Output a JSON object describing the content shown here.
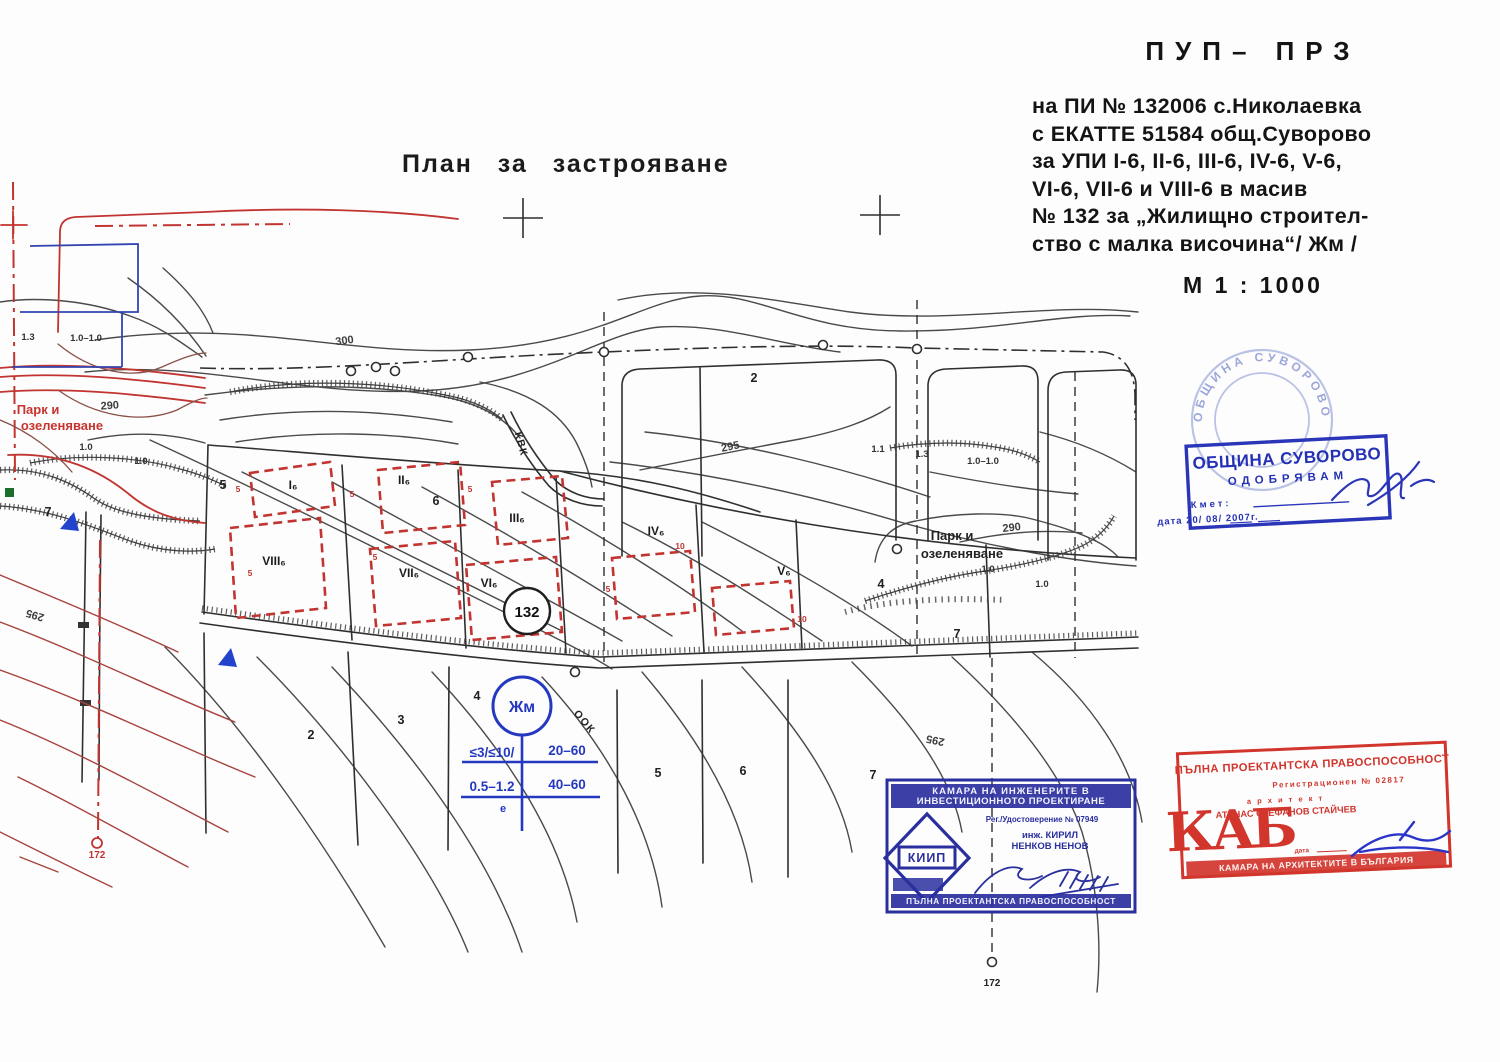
{
  "header": {
    "plan_title": "План за застрояване",
    "doc_type": "ПУП– ПРЗ",
    "line1": "на ПИ  №  132006  с.Николаевка",
    "line2": "с ЕКАТТЕ  51584  общ.Суворово",
    "line3": "за УПИ  I-6, II-6,  III-6, IV-6, V-6,",
    "line4": "VI-6, VII-6  и  VIII-6  в  масив",
    "line5": "№ 132  за „Жилищно  строител-",
    "line6": "ство  с малка  височина“/ Жм /",
    "scale": "М  1 : 1000"
  },
  "legend": {
    "zone": "Жм",
    "row1_left": "≤3/≤10/",
    "row1_right": "20–60",
    "row2_left": "0.5–1.2",
    "row2_right": "40–60",
    "note": "е"
  },
  "map": {
    "massif_number": "132",
    "labels": [
      {
        "t": "300",
        "x": 345,
        "y": 344,
        "cls": "cont",
        "rot": -8
      },
      {
        "t": "295",
        "x": 731,
        "y": 450,
        "cls": "cont",
        "rot": -12
      },
      {
        "t": "290",
        "x": 1012,
        "y": 531,
        "cls": "cont",
        "rot": -6
      },
      {
        "t": "295",
        "x": 36,
        "y": 612,
        "cls": "cont",
        "rot": 197
      },
      {
        "t": "295",
        "x": 936,
        "y": 737,
        "cls": "cont",
        "rot": 192
      },
      {
        "t": "290",
        "x": 110,
        "y": 409,
        "cls": "cont",
        "rot": -4
      },
      {
        "t": "2",
        "x": 754,
        "y": 382,
        "cls": "plot"
      },
      {
        "t": "2",
        "x": 311,
        "y": 739,
        "cls": "plot"
      },
      {
        "t": "3",
        "x": 401,
        "y": 724,
        "cls": "plot"
      },
      {
        "t": "4",
        "x": 477,
        "y": 700,
        "cls": "plot"
      },
      {
        "t": "5",
        "x": 658,
        "y": 777,
        "cls": "plot"
      },
      {
        "t": "6",
        "x": 743,
        "y": 775,
        "cls": "plot"
      },
      {
        "t": "7",
        "x": 873,
        "y": 779,
        "cls": "plot"
      },
      {
        "t": "7",
        "x": 957,
        "y": 638,
        "cls": "plot"
      },
      {
        "t": "7",
        "x": 48,
        "y": 516,
        "cls": "plot"
      },
      {
        "t": "5",
        "x": 223,
        "y": 489,
        "cls": "plot"
      },
      {
        "t": "4",
        "x": 881,
        "y": 588,
        "cls": "plot"
      },
      {
        "t": "6",
        "x": 436,
        "y": 505,
        "cls": "plot"
      },
      {
        "t": "I₆",
        "x": 293,
        "y": 489,
        "cls": "upi"
      },
      {
        "t": "II₆",
        "x": 404,
        "y": 484,
        "cls": "upi"
      },
      {
        "t": "III₆",
        "x": 517,
        "y": 522,
        "cls": "upi"
      },
      {
        "t": "IV₆",
        "x": 656,
        "y": 535,
        "cls": "upi"
      },
      {
        "t": "V₆",
        "x": 784,
        "y": 575,
        "cls": "upi"
      },
      {
        "t": "VI₆",
        "x": 489,
        "y": 587,
        "cls": "upi"
      },
      {
        "t": "VII₆",
        "x": 409,
        "y": 577,
        "cls": "upi"
      },
      {
        "t": "VIII₆",
        "x": 274,
        "y": 565,
        "cls": "upi"
      },
      {
        "t": "1.3",
        "x": 28,
        "y": 340,
        "cls": "small"
      },
      {
        "t": "1.0–1.0",
        "x": 86,
        "y": 341,
        "cls": "small"
      },
      {
        "t": "1.1",
        "x": 878,
        "y": 452,
        "cls": "small"
      },
      {
        "t": "1.3",
        "x": 922,
        "y": 457,
        "cls": "small"
      },
      {
        "t": "1.0–1.0",
        "x": 983,
        "y": 464,
        "cls": "small"
      },
      {
        "t": "1.0",
        "x": 988,
        "y": 572,
        "cls": "small"
      },
      {
        "t": "1.0",
        "x": 1042,
        "y": 587,
        "cls": "small"
      },
      {
        "t": "1.0",
        "x": 86,
        "y": 450,
        "cls": "small"
      },
      {
        "t": "1.0",
        "x": 141,
        "y": 464,
        "cls": "small"
      },
      {
        "t": "172",
        "x": 992,
        "y": 986,
        "cls": "pt"
      },
      {
        "t": "172",
        "x": 97,
        "y": 858,
        "cls": "ptred"
      },
      {
        "t": "Парк и",
        "x": 38,
        "y": 414,
        "cls": "parkred"
      },
      {
        "t": "озеленяване",
        "x": 62,
        "y": 430,
        "cls": "parkred"
      },
      {
        "t": "Парк и",
        "x": 952,
        "y": 540,
        "cls": "parkblk"
      },
      {
        "t": "озеленяване",
        "x": 962,
        "y": 558,
        "cls": "parkblk"
      },
      {
        "t": "КВК",
        "x": 518,
        "y": 445,
        "cls": "rotlab",
        "rot": 75
      },
      {
        "t": "ООК",
        "x": 582,
        "y": 724,
        "cls": "rotlab",
        "rot": 50
      },
      {
        "t": "5",
        "x": 238,
        "y": 492,
        "cls": "dim"
      },
      {
        "t": "5",
        "x": 352,
        "y": 497,
        "cls": "dim"
      },
      {
        "t": "5",
        "x": 470,
        "y": 492,
        "cls": "dim"
      },
      {
        "t": "5",
        "x": 250,
        "y": 576,
        "cls": "dim"
      },
      {
        "t": "5",
        "x": 375,
        "y": 560,
        "cls": "dim"
      },
      {
        "t": "5",
        "x": 608,
        "y": 592,
        "cls": "dim"
      },
      {
        "t": "10",
        "x": 680,
        "y": 549,
        "cls": "dim"
      },
      {
        "t": "10",
        "x": 802,
        "y": 622,
        "cls": "dim"
      }
    ]
  },
  "stamps": {
    "municipality": {
      "seal_text": "ОБЩИНА СУВОРОВО",
      "title": "ОБЩИНА СУВОРОВО",
      "action": "ОДОБРЯВАМ",
      "mayor_label": "Кмет:",
      "date_line": "дата 20/ 08/ 2007г."
    },
    "kiip": {
      "org_line1": "КАМАРА НА ИНЖЕНЕРИТЕ В",
      "org_line2": "ИНВЕСТИЦИОННОТО ПРОЕКТИРАНЕ",
      "reg": "Рег./Удостоверение № 07949",
      "logo": "КИИП",
      "engineer_line1": "инж. КИРИЛ",
      "engineer_line2": "НЕНКОВ НЕНОВ",
      "bottom": "ПЪЛНА ПРОЕКТАНТСКА ПРАВОСПОСОБНОСТ"
    },
    "kab": {
      "top": "ПЪЛНА ПРОЕКТАНТСКА ПРАВОСПОСОБНОСТ",
      "reg": "Регистрационен № 02817",
      "role": "а р х и т е к т",
      "name": "АТАНАС СТЕФАНОВ СТАЙЧЕВ",
      "logo": "КАБ",
      "date_label": "дата",
      "bottom": "КАМАРА НА АРХИТЕКТИТЕ В БЪЛГАРИЯ"
    }
  }
}
